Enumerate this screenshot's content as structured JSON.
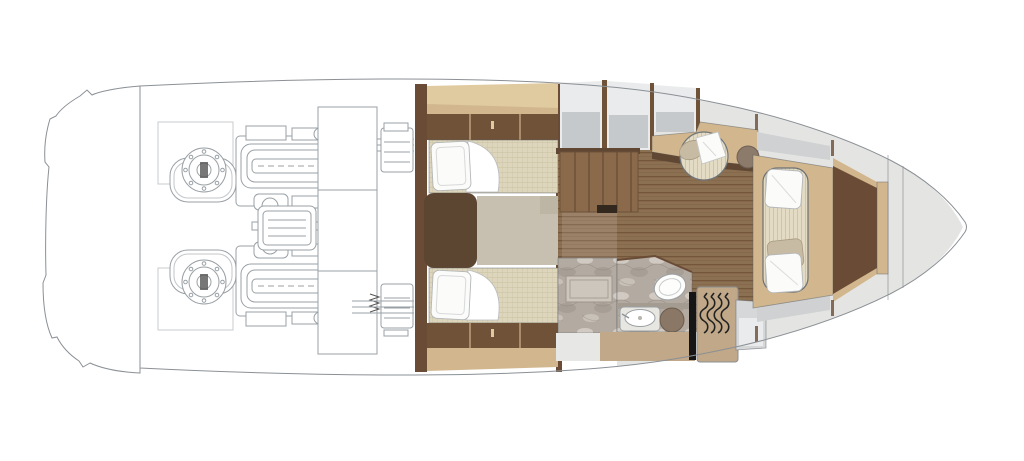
{
  "title": "yacht-lower-deck-floorplan",
  "colors": {
    "hull_line": "#8b9095",
    "engine_line": "#99a0a5",
    "deck": "#e4e5e3",
    "deck_panel": "#d5d7d8",
    "deck_panel2": "#cfd1d2",
    "panel_light": "#eaebec",
    "panel_gray": "#c6c9cc",
    "wall_brown": "#6a4c36",
    "cabinet_brown": "#6f5238",
    "shadow_brown": "#5f4733",
    "tan": "#d2b78e",
    "tan_light": "#e0ca9f",
    "teak": "#8c7052",
    "teak_line": "#74573b",
    "stair_wood": "#8a6a4b",
    "stair_line": "#6d5138",
    "mattress": "#ded6bc",
    "mattress_line": "#cdc4a6",
    "filler": "#c7c0b0",
    "headboard": "#5c4531",
    "marble": "#b3aaa1",
    "marble_light": "#d6d0c8",
    "marble_dark": "#968d83",
    "marble_vein": "#8a8178",
    "sofa": "#e3dbc3",
    "sofa_line": "#cec4a7",
    "pillow_white": "#fbfbfa",
    "pillow_taupe": "#c8bba3",
    "stool": "#8b7765",
    "door_black": "#161616",
    "locker": "#c0a888",
    "counter": "#a49c90",
    "bench": "#cdc6bd",
    "white": "#ffffff"
  },
  "areas": {
    "hull": "hull outline with swim platform",
    "engine_room": "engine room",
    "engine_port": "port engine",
    "engine_starboard": "starboard engine",
    "tank": "tank between engines",
    "service_column": "engine room lockers",
    "generator": "generator unit",
    "bulkhead": "engine room bulkhead",
    "twin_cabin": "twin guest cabin",
    "bed_port": "port single berth",
    "bed_starboard": "starboard single berth",
    "bed_filler": "berth infill cushion",
    "headboard": "berth headboard",
    "wardrobe_port": "port wardrobe",
    "wardrobe_starboard": "starboard wardrobe",
    "galley_cabinets": "side cabinets",
    "staircase": "companionway stairs",
    "corridor": "corridor",
    "shower": "shower compartment",
    "head": "head / bathroom",
    "toilet": "toilet",
    "sink": "washbasin",
    "stool": "vanity stool",
    "door": "bathroom door",
    "hanging_locker": "hanging locker",
    "salon": "salon with teak floor",
    "armchair": "armchair with throw",
    "side_table": "round side table",
    "console": "console / desk",
    "sofa": "bow sofa with pillows",
    "bow_berth": "forward berth area",
    "side_decks": "side decks",
    "bow": "bow section"
  }
}
